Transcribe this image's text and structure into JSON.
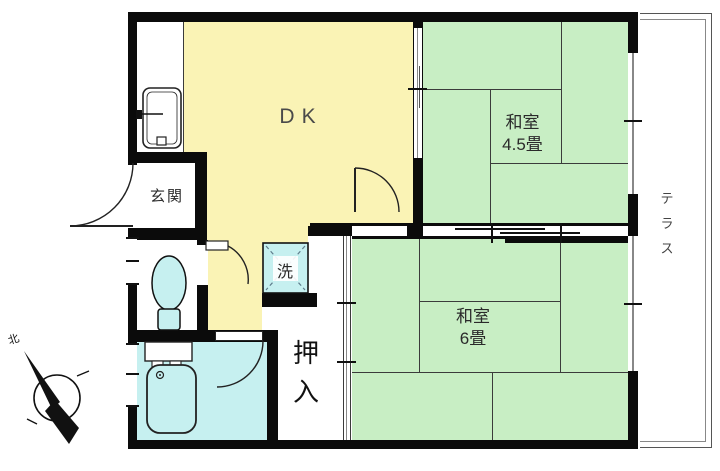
{
  "rooms": {
    "dk": {
      "label": "DK"
    },
    "washitsu_45": {
      "name": "和室",
      "size": "4.5畳"
    },
    "washitsu_6": {
      "name": "和室",
      "size": "6畳"
    },
    "genkan": {
      "label": "玄関"
    },
    "oshiire": {
      "label": "押入"
    },
    "laundry": {
      "label": "洗"
    },
    "terrace": {
      "label": "テラス"
    }
  },
  "compass": {
    "north_label": "北"
  },
  "colors": {
    "dk_floor": "#FAF3B5",
    "tatami_floor": "#C8EEC4",
    "water_floor": "#C6F0F0",
    "wall": "#0B0B0B"
  }
}
